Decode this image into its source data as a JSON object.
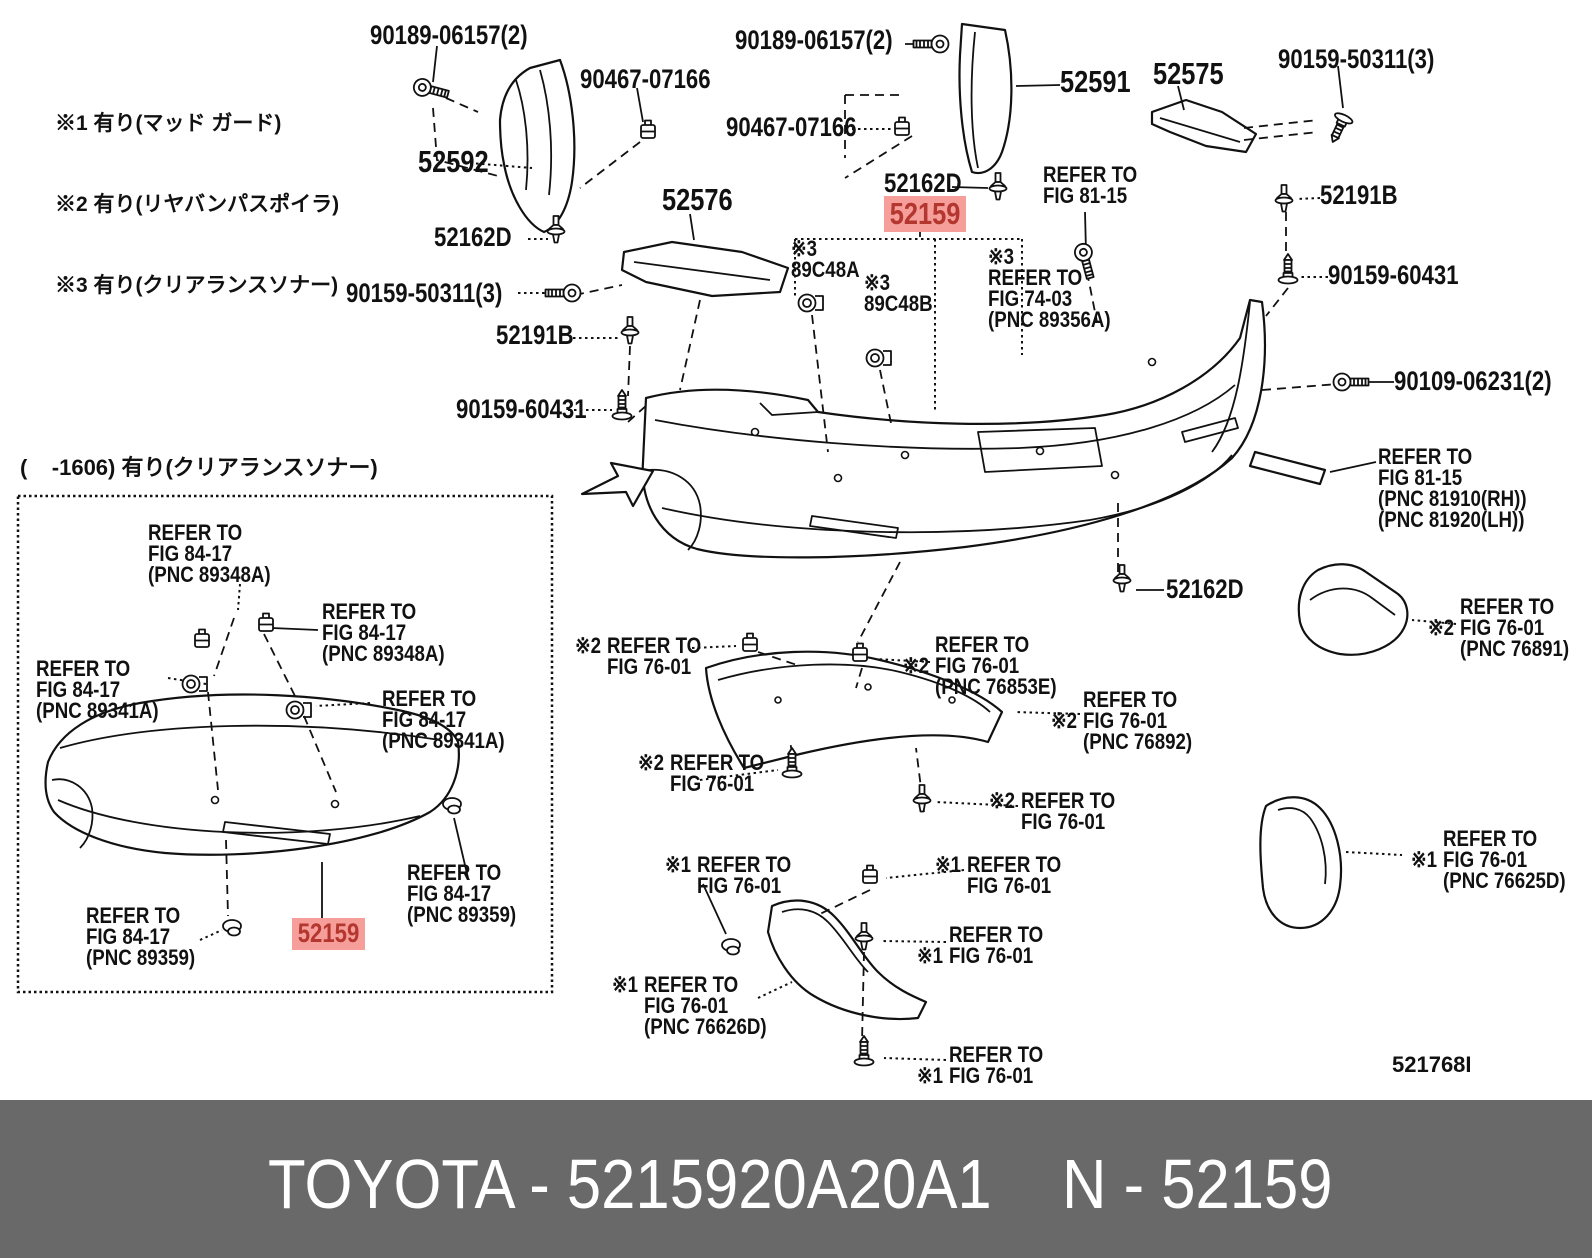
{
  "notes": {
    "lines": [
      "※1 有り(マッド ガード)",
      "※2 有り(リヤバンパスポイラ)",
      "※3 有り(クリアランスソナー)"
    ]
  },
  "inset": {
    "header": "(    -1606) 有り(クリアランスソナー)"
  },
  "colors": {
    "highlight_bg": "#f59e9a",
    "highlight_text": "#b3362f",
    "footer_bg": "#696969",
    "line": "#111111"
  },
  "diagram_code": "521768I",
  "footer": {
    "left": "TOYOTA - 5215920A20A1",
    "right": "N - 52159"
  },
  "labels": [
    {
      "text": "90189-06157(2)"
    },
    {
      "text": "52592"
    },
    {
      "text": "90467-07166"
    },
    {
      "text": "52162D"
    },
    {
      "text": "90159-50311(3)"
    },
    {
      "text": "52191B"
    },
    {
      "text": "90159-60431"
    },
    {
      "text": "52576"
    },
    {
      "text": "90189-06157(2)"
    },
    {
      "text": "52591"
    },
    {
      "text": "90467-07166"
    },
    {
      "text": "52162D"
    },
    {
      "text": "52159",
      "highlight": true
    },
    {
      "text": "52575"
    },
    {
      "text": "90159-50311(3)"
    },
    {
      "text": "52191B"
    },
    {
      "text": "90159-60431"
    },
    {
      "text": "90109-06231(2)"
    },
    {
      "text": "52162D"
    },
    {
      "text": "REFER TO\nFIG 81-15"
    },
    {
      "text": "※3\n89C48A"
    },
    {
      "text": "※3\n89C48B"
    },
    {
      "text": "※3\nREFER TO\nFIG 74-03\n(PNC 89356A)"
    },
    {
      "text": "REFER TO\nFIG 81-15\n(PNC 81910(RH))\n(PNC 81920(LH))"
    },
    {
      "prefix": "※2",
      "text": "REFER TO\nFIG 76-01\n(PNC 76891)"
    },
    {
      "prefix": "※2",
      "text": "REFER TO\nFIG 76-01"
    },
    {
      "prefix": "※2",
      "text": "REFER TO\nFIG 76-01\n(PNC 76853E)"
    },
    {
      "prefix": "※2",
      "text": "REFER TO\nFIG 76-01\n(PNC 76892)"
    },
    {
      "prefix": "※2",
      "text": "REFER TO\nFIG 76-01"
    },
    {
      "prefix": "※2",
      "text": "REFER TO\nFIG 76-01"
    },
    {
      "prefix": "※1",
      "text": "REFER TO\nFIG 76-01"
    },
    {
      "prefix": "※1",
      "text": "REFER TO\nFIG 76-01"
    },
    {
      "prefix": "※1",
      "text": "REFER TO\nFIG 76-01"
    },
    {
      "prefix": "※1",
      "text": "REFER TO\nFIG 76-01\n(PNC 76626D)"
    },
    {
      "prefix": "※1",
      "text": "REFER TO\nFIG 76-01"
    },
    {
      "prefix": "※1",
      "text": "REFER TO\nFIG 76-01\n(PNC 76625D)"
    },
    {
      "text": "REFER TO\nFIG 84-17\n(PNC 89348A)"
    },
    {
      "text": "REFER TO\nFIG 84-17\n(PNC 89348A)"
    },
    {
      "text": "REFER TO\nFIG 84-17\n(PNC 89341A)"
    },
    {
      "text": "REFER TO\nFIG 84-17\n(PNC 89341A)"
    },
    {
      "text": "REFER TO\nFIG 84-17\n(PNC 89359)"
    },
    {
      "text": "REFER TO\nFIG 84-17\n(PNC 89359)"
    },
    {
      "text": "52159",
      "highlight": true
    }
  ]
}
